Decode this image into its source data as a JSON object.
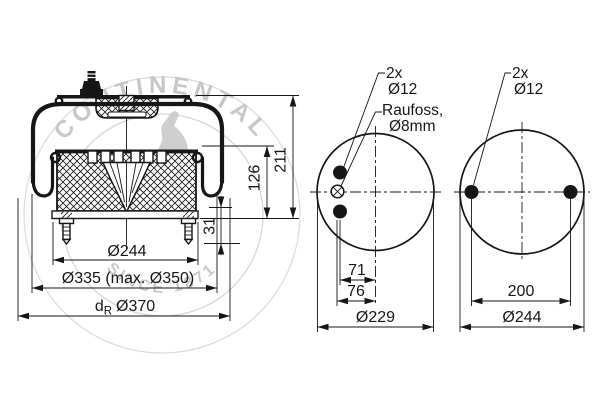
{
  "watermark": {
    "brand": "CONTINENTAL",
    "since": "SINCE 1871"
  },
  "side_view": {
    "dims": {
      "total_height": "211",
      "piston_height": "126",
      "stud_projection": "31",
      "piston_dia": "Ø244",
      "bellows_dia": "Ø335 (max. Ø350)",
      "rolling_dia_prefix": "d",
      "rolling_dia_sub": "R",
      "rolling_dia_value": "Ø370"
    }
  },
  "top_view": {
    "labels": {
      "stud_count": "2x",
      "stud_dia": "Ø12",
      "fitting_name": "Raufoss,",
      "fitting_dia": "Ø8mm"
    },
    "dims": {
      "stud_offset": "71",
      "fitting_offset": "76",
      "plate_dia": "Ø229"
    }
  },
  "bottom_view": {
    "labels": {
      "stud_count": "2x",
      "stud_dia": "Ø12"
    },
    "dims": {
      "stud_spacing": "200",
      "plate_dia": "Ø244"
    }
  },
  "colors": {
    "line": "#161616",
    "watermark": "#c7c7c7",
    "background": "#ffffff"
  }
}
